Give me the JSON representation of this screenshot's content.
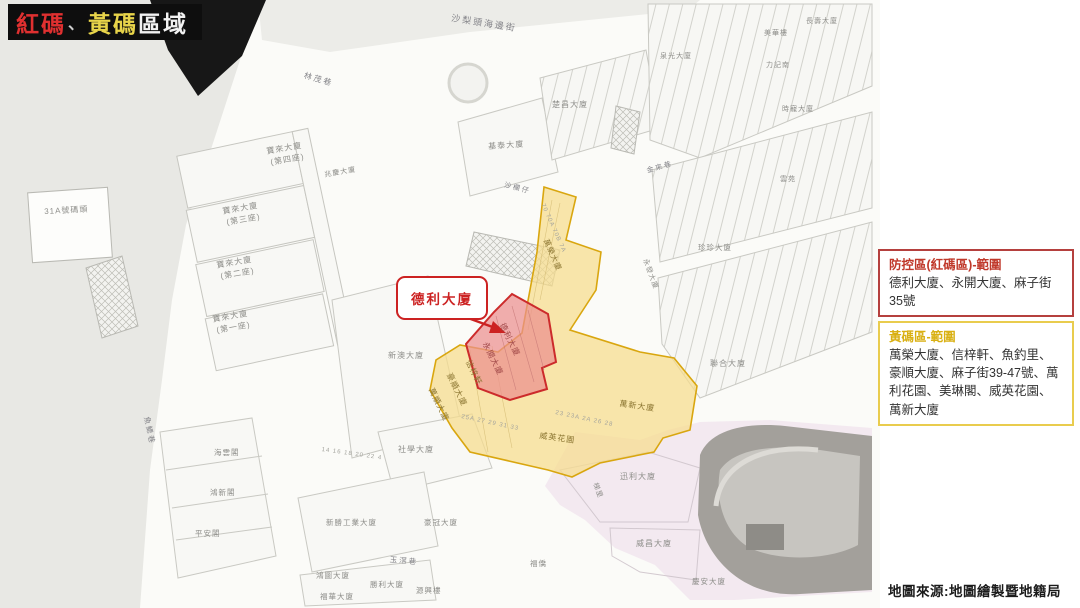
{
  "title": {
    "part_red": "紅碼",
    "separator": "、",
    "part_yellow": "黃碼",
    "part_rest": "區域"
  },
  "legend_red": {
    "header": "防控區(紅碼區)-範圍",
    "content": "德利大廈、永開大廈、麻子街35號"
  },
  "legend_yellow": {
    "header": "黃碼區-範圍",
    "content": "萬榮大廈、信梓軒、魚釣里、豪順大廈、麻子街39-47號、萬利花園、美琳閣、威英花園、萬新大廈"
  },
  "callout": {
    "label": "德利大廈"
  },
  "source_note": "地圖來源:地圖繪製暨地籍局",
  "colors": {
    "red_zone_fill": "#ec8f8f",
    "red_zone_stroke": "#cc2b2b",
    "yellow_zone_fill": "#f6dd8c",
    "yellow_zone_stroke": "#d9a60f",
    "legend_red_border": "#b5403e",
    "legend_red_header": "#c0392b",
    "legend_yellow_border": "#e9cc4e",
    "legend_yellow_header": "#d9b012",
    "title_red": "#e03030",
    "title_yellow": "#e8d44a",
    "banner_bg": "#0e0e0e",
    "water": "#e8e8e4",
    "park": "#a3a09b",
    "pink_district": "#f0e3ee"
  },
  "map": {
    "labels": [
      {
        "t": "沙梨頭海邊街",
        "x": 452,
        "y": 14,
        "r": 9,
        "c": "street",
        "s": 9
      },
      {
        "t": "林茂巷",
        "x": 305,
        "y": 72,
        "r": 16,
        "c": "street",
        "s": 8
      },
      {
        "t": "沙欄仔",
        "x": 505,
        "y": 182,
        "r": 14,
        "c": "street",
        "s": 7
      },
      {
        "t": "31A號碼頭",
        "x": 44,
        "y": 208,
        "r": -3,
        "s": 8
      },
      {
        "t": "寶來大廈",
        "x": 266,
        "y": 148,
        "r": -10,
        "s": 8
      },
      {
        "t": "(第四座)",
        "x": 270,
        "y": 159,
        "r": -10,
        "s": 8
      },
      {
        "t": "兆慶大廈",
        "x": 324,
        "y": 172,
        "r": -10,
        "s": 7
      },
      {
        "t": "寶來大廈",
        "x": 222,
        "y": 208,
        "r": -10,
        "s": 8
      },
      {
        "t": "(第三座)",
        "x": 226,
        "y": 219,
        "r": -10,
        "s": 8
      },
      {
        "t": "寶來大廈",
        "x": 216,
        "y": 262,
        "r": -10,
        "s": 8
      },
      {
        "t": "(第二座)",
        "x": 220,
        "y": 273,
        "r": -10,
        "s": 8
      },
      {
        "t": "寶來大廈",
        "x": 212,
        "y": 316,
        "r": -10,
        "s": 8
      },
      {
        "t": "(第一座)",
        "x": 216,
        "y": 327,
        "r": -10,
        "s": 8
      },
      {
        "t": "基泰大廈",
        "x": 488,
        "y": 143,
        "r": -4,
        "s": 8
      },
      {
        "t": "楚昌大廈",
        "x": 552,
        "y": 101,
        "r": 0,
        "s": 8
      },
      {
        "t": "泉光大廈",
        "x": 660,
        "y": 53,
        "r": 0,
        "s": 7
      },
      {
        "t": "美華樓",
        "x": 764,
        "y": 30,
        "r": 0,
        "s": 7
      },
      {
        "t": "力記南",
        "x": 766,
        "y": 62,
        "r": 0,
        "s": 7
      },
      {
        "t": "長壽大廈",
        "x": 806,
        "y": 18,
        "r": 0,
        "s": 7
      },
      {
        "t": "時寵大廈",
        "x": 782,
        "y": 106,
        "r": 0,
        "s": 7
      },
      {
        "t": "雲苑",
        "x": 780,
        "y": 176,
        "r": 0,
        "s": 7
      },
      {
        "t": "金來巷",
        "x": 646,
        "y": 168,
        "r": -16,
        "c": "street",
        "s": 7
      },
      {
        "t": "珍珍大廈",
        "x": 698,
        "y": 244,
        "r": 0,
        "s": 7.5
      },
      {
        "t": "永發大廈",
        "x": 648,
        "y": 258,
        "r": 70,
        "s": 7
      },
      {
        "t": "聯合大廈",
        "x": 710,
        "y": 360,
        "r": 0,
        "s": 8
      },
      {
        "t": "新澳大廈",
        "x": 388,
        "y": 352,
        "r": 0,
        "s": 8
      },
      {
        "t": "魚鰓巷",
        "x": 150,
        "y": 416,
        "r": 78,
        "c": "street",
        "s": 7.5
      },
      {
        "t": "海雲閣",
        "x": 214,
        "y": 449,
        "r": 0,
        "s": 7.5
      },
      {
        "t": "鴻新閣",
        "x": 210,
        "y": 489,
        "r": 0,
        "s": 7.5
      },
      {
        "t": "平安閣",
        "x": 195,
        "y": 530,
        "r": 0,
        "s": 7.5
      },
      {
        "t": "社學大廈",
        "x": 398,
        "y": 446,
        "r": 0,
        "s": 8
      },
      {
        "t": "新勝工業大廈",
        "x": 326,
        "y": 519,
        "r": 0,
        "s": 7.5
      },
      {
        "t": "豪冠大廈",
        "x": 424,
        "y": 519,
        "r": 0,
        "s": 7.5
      },
      {
        "t": "玉滘巷",
        "x": 390,
        "y": 556,
        "r": 5,
        "c": "street",
        "s": 7.5
      },
      {
        "t": "鴻圖大廈",
        "x": 316,
        "y": 572,
        "r": 0,
        "s": 7.5
      },
      {
        "t": "勝利大廈",
        "x": 370,
        "y": 581,
        "r": 0,
        "s": 7.5
      },
      {
        "t": "福華大廈",
        "x": 320,
        "y": 593,
        "r": 0,
        "s": 7.5
      },
      {
        "t": "迅利大廈",
        "x": 620,
        "y": 473,
        "r": 0,
        "s": 8
      },
      {
        "t": "梯里",
        "x": 598,
        "y": 482,
        "r": 70,
        "s": 7
      },
      {
        "t": "威昌大廈",
        "x": 636,
        "y": 540,
        "r": 0,
        "s": 8
      },
      {
        "t": "福僑",
        "x": 530,
        "y": 560,
        "r": 0,
        "s": 7.5
      },
      {
        "t": "源興樓",
        "x": 416,
        "y": 587,
        "r": 0,
        "s": 7.5
      },
      {
        "t": "慶安大廈",
        "x": 692,
        "y": 578,
        "r": 0,
        "s": 7.5
      },
      {
        "t": "德利大廈",
        "x": 505,
        "y": 322,
        "r": 64,
        "c": "rz",
        "s": 8
      },
      {
        "t": "永開大廈",
        "x": 488,
        "y": 341,
        "r": 64,
        "c": "rz",
        "s": 8
      },
      {
        "t": "信梓軒",
        "x": 471,
        "y": 359,
        "r": 64,
        "c": "yz",
        "s": 8
      },
      {
        "t": "豪順大廈",
        "x": 452,
        "y": 372,
        "r": 64,
        "c": "yz",
        "s": 8
      },
      {
        "t": "萬順大廈",
        "x": 434,
        "y": 387,
        "r": 64,
        "c": "yz",
        "s": 8
      },
      {
        "t": "威英花園",
        "x": 540,
        "y": 432,
        "r": 8,
        "c": "yz",
        "s": 8
      },
      {
        "t": "萬新大廈",
        "x": 620,
        "y": 400,
        "r": 8,
        "c": "yz",
        "s": 8
      },
      {
        "t": "萬榮大廈",
        "x": 549,
        "y": 238,
        "r": 66,
        "c": "yz",
        "s": 7.5
      },
      {
        "t": "70 70A 70B 7A",
        "x": 545,
        "y": 203,
        "r": 66,
        "c": "nums",
        "s": 6
      },
      {
        "t": "25A 27 29 31 33",
        "x": 462,
        "y": 414,
        "r": 12,
        "c": "nums",
        "s": 6
      },
      {
        "t": "23 23A 2A 26 28",
        "x": 556,
        "y": 410,
        "r": 12,
        "c": "nums",
        "s": 6
      },
      {
        "t": "14 16 18 20 22 4",
        "x": 322,
        "y": 447,
        "r": 8,
        "c": "nums",
        "s": 6
      }
    ]
  }
}
